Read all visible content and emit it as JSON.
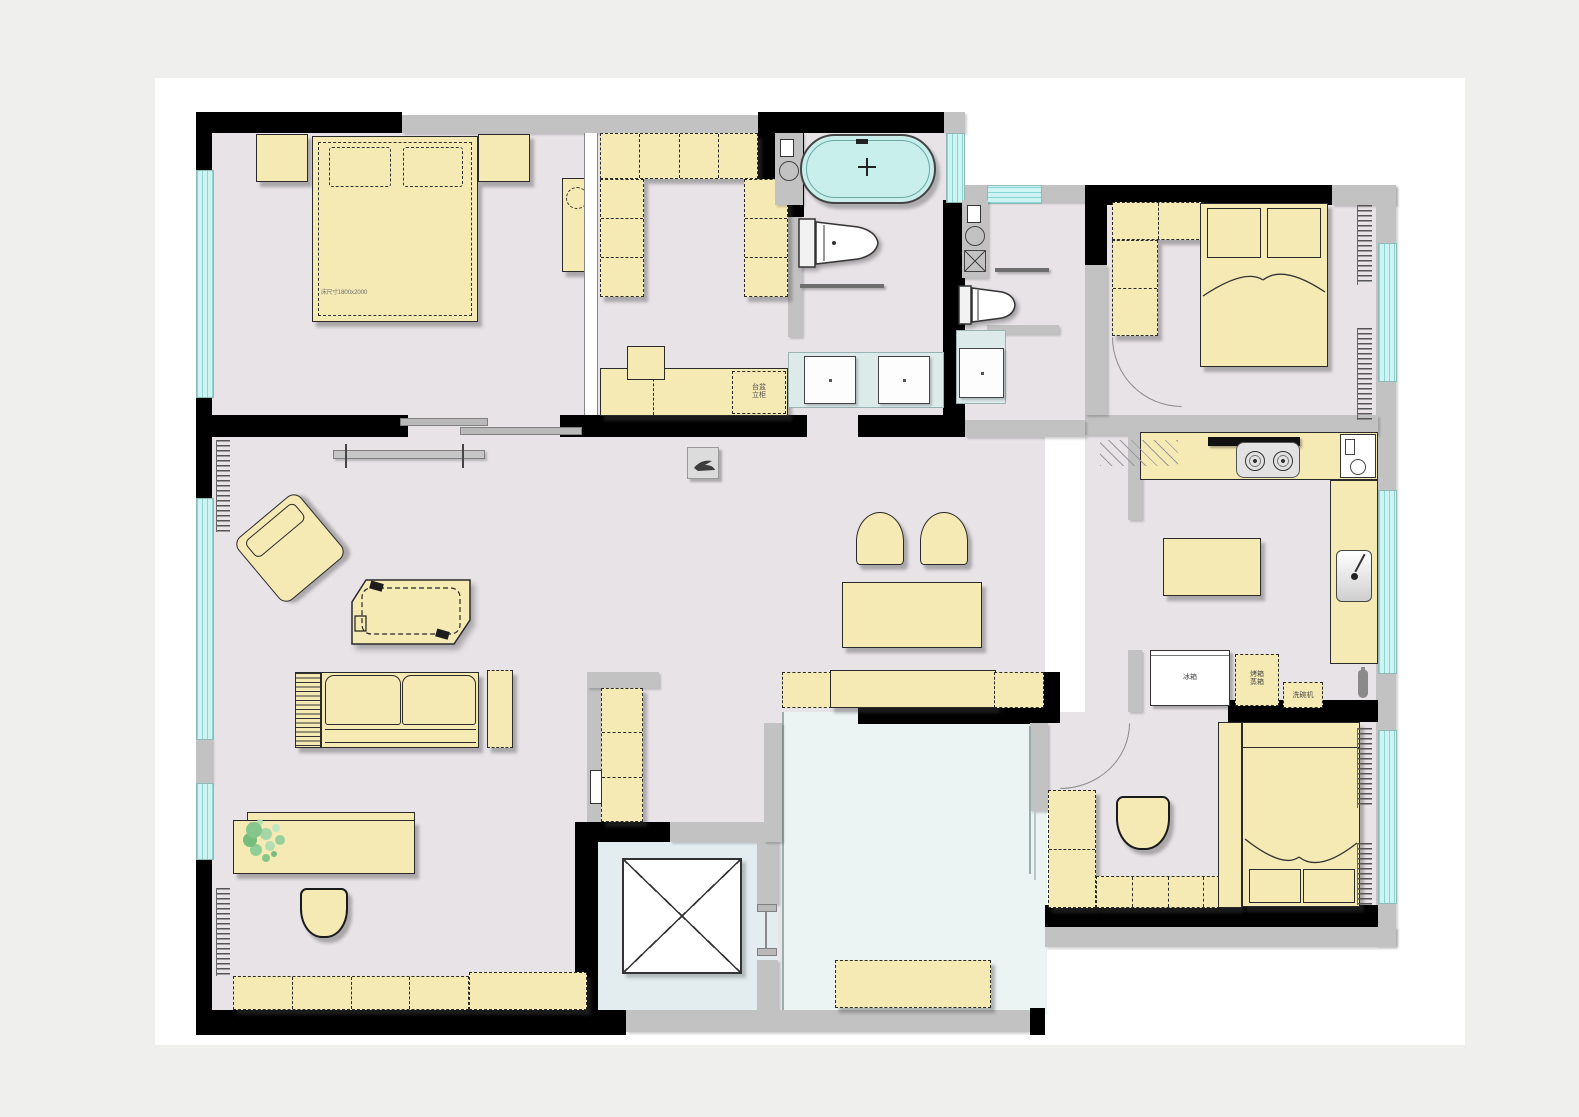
{
  "plan": {
    "type": "apartment-floor-plan",
    "colors": {
      "background": "#efefee",
      "paper": "#ffffff",
      "floor": "#e7e3e7",
      "furniture": "#f5e9b4",
      "wall": "#000000",
      "structure_gray": "#c2c2c2",
      "window_glass": "#cdf4f2",
      "bathtub_water": "#c8efec",
      "terrace_floor": "#ebf4f3",
      "elevator_floor": "#e3edef",
      "vanity_counter": "#dceaea",
      "plant_green": "#86c58b"
    },
    "annotations": {
      "master_bed_size": "床尺寸1800x2000",
      "closet_cabinet": [
        "台盆",
        "立柜"
      ],
      "fridge": "冰箱",
      "oven_cabinet": [
        "烤箱",
        "蒸箱"
      ],
      "dishwasher": "洗碗机"
    },
    "rooms": [
      {
        "id": "master-bedroom",
        "furniture": [
          "double-bed",
          "pillow x2",
          "nightstand x2",
          "dresser-with-mirror"
        ]
      },
      {
        "id": "walk-in-closet",
        "furniture": [
          "wardrobe-top-run",
          "wardrobe-left-column",
          "wardrobe-right-column",
          "storage-bench",
          "drawer-box"
        ]
      },
      {
        "id": "master-bathroom",
        "furniture": [
          "bathtub",
          "toilet",
          "towel-bar",
          "double-vanity-sinks",
          "wash-column"
        ]
      },
      {
        "id": "hall-bathroom",
        "furniture": [
          "laundry-column",
          "toilet",
          "towel-bar",
          "vanity-sink"
        ]
      },
      {
        "id": "bedroom-2",
        "furniture": [
          "bed",
          "l-shaped-wardrobe",
          "radiator x2",
          "door"
        ]
      },
      {
        "id": "kitchen",
        "furniture": [
          "range-hood",
          "gas-stove",
          "water-heater",
          "sink",
          "island",
          "refrigerator",
          "oven-cabinet",
          "dishwasher"
        ]
      },
      {
        "id": "bedroom-3",
        "furniture": [
          "bed",
          "l-shaped-desk",
          "chair",
          "radiator x2",
          "door"
        ]
      },
      {
        "id": "living-dining",
        "furniture": [
          "wall-shelf",
          "decor-box",
          "armchair",
          "chaise-lounge",
          "sofa",
          "side-table",
          "desk",
          "plant",
          "desk-chair",
          "cabinet-row",
          "dining-table",
          "dining-chair x2",
          "bench-row"
        ]
      },
      {
        "id": "elevator",
        "furniture": [
          "elevator-shaft-x"
        ]
      },
      {
        "id": "terrace",
        "furniture": [
          "glass-partition",
          "bench"
        ]
      }
    ]
  }
}
